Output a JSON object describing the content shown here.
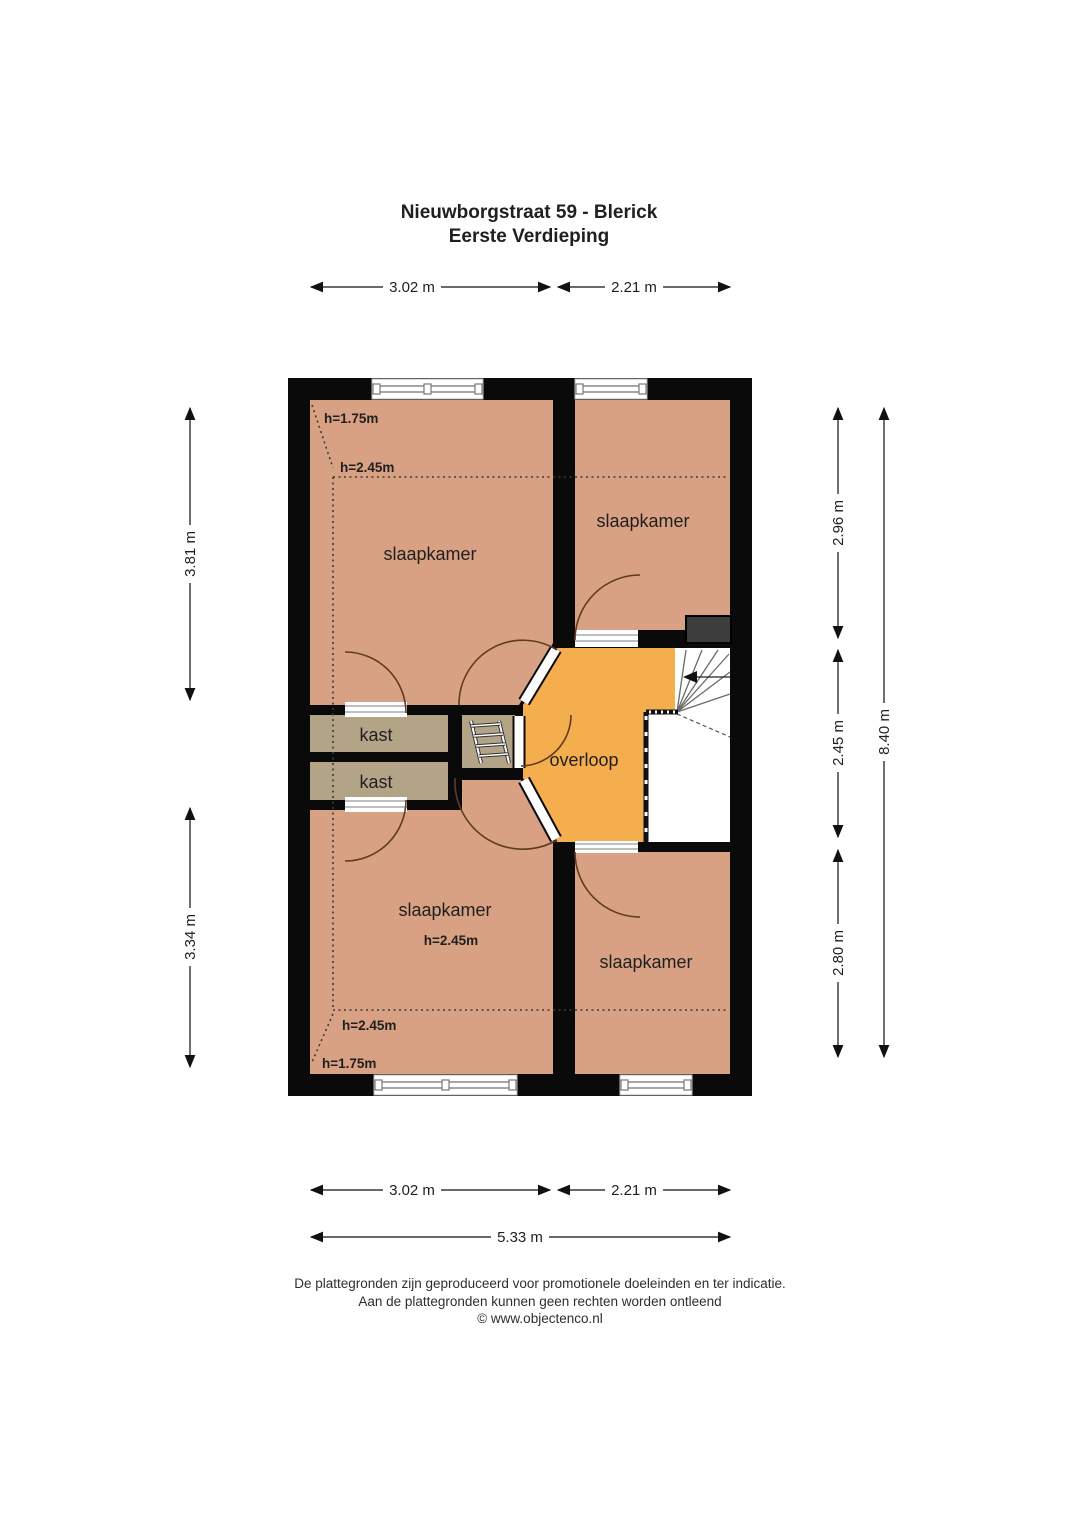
{
  "title": {
    "line1": "Nieuwborgstraat 59 - Blerick",
    "line2": "Eerste Verdieping"
  },
  "rooms": {
    "bedroom_top_left": "slaapkamer",
    "bedroom_top_right": "slaapkamer",
    "bedroom_bottom_left": "slaapkamer",
    "bedroom_bottom_right": "slaapkamer",
    "closet_top": "kast",
    "closet_bottom": "kast",
    "landing": "overloop"
  },
  "heights": {
    "top_left_low": "h=1.75m",
    "top_left_main": "h=2.45m",
    "bottom_room": "h=2.45m",
    "bottom_main": "h=2.45m",
    "bottom_low": "h=1.75m"
  },
  "dimensions": {
    "top_width_left": "3.02 m",
    "top_width_right": "2.21 m",
    "bottom_width_left": "3.02 m",
    "bottom_width_right": "2.21 m",
    "bottom_width_total": "5.33 m",
    "left_height_top": "3.81 m",
    "left_height_bottom": "3.34 m",
    "right_height_top": "2.96 m",
    "right_height_middle": "2.45 m",
    "right_height_bottom": "2.80 m",
    "right_height_total": "8.40 m"
  },
  "footer": {
    "line1": "De plattegronden zijn geproduceerd voor promotionele doeleinden en ter indicatie.",
    "line2": "Aan de plattegronden kunnen geen rechten worden ontleend",
    "line3": "© www.objectenco.nl"
  },
  "colors": {
    "wall": "#0a0a0a",
    "room": "#d9a183",
    "landing": "#f5ae4d",
    "closet": "#b4a487",
    "chimney": "#3d3d3d"
  }
}
